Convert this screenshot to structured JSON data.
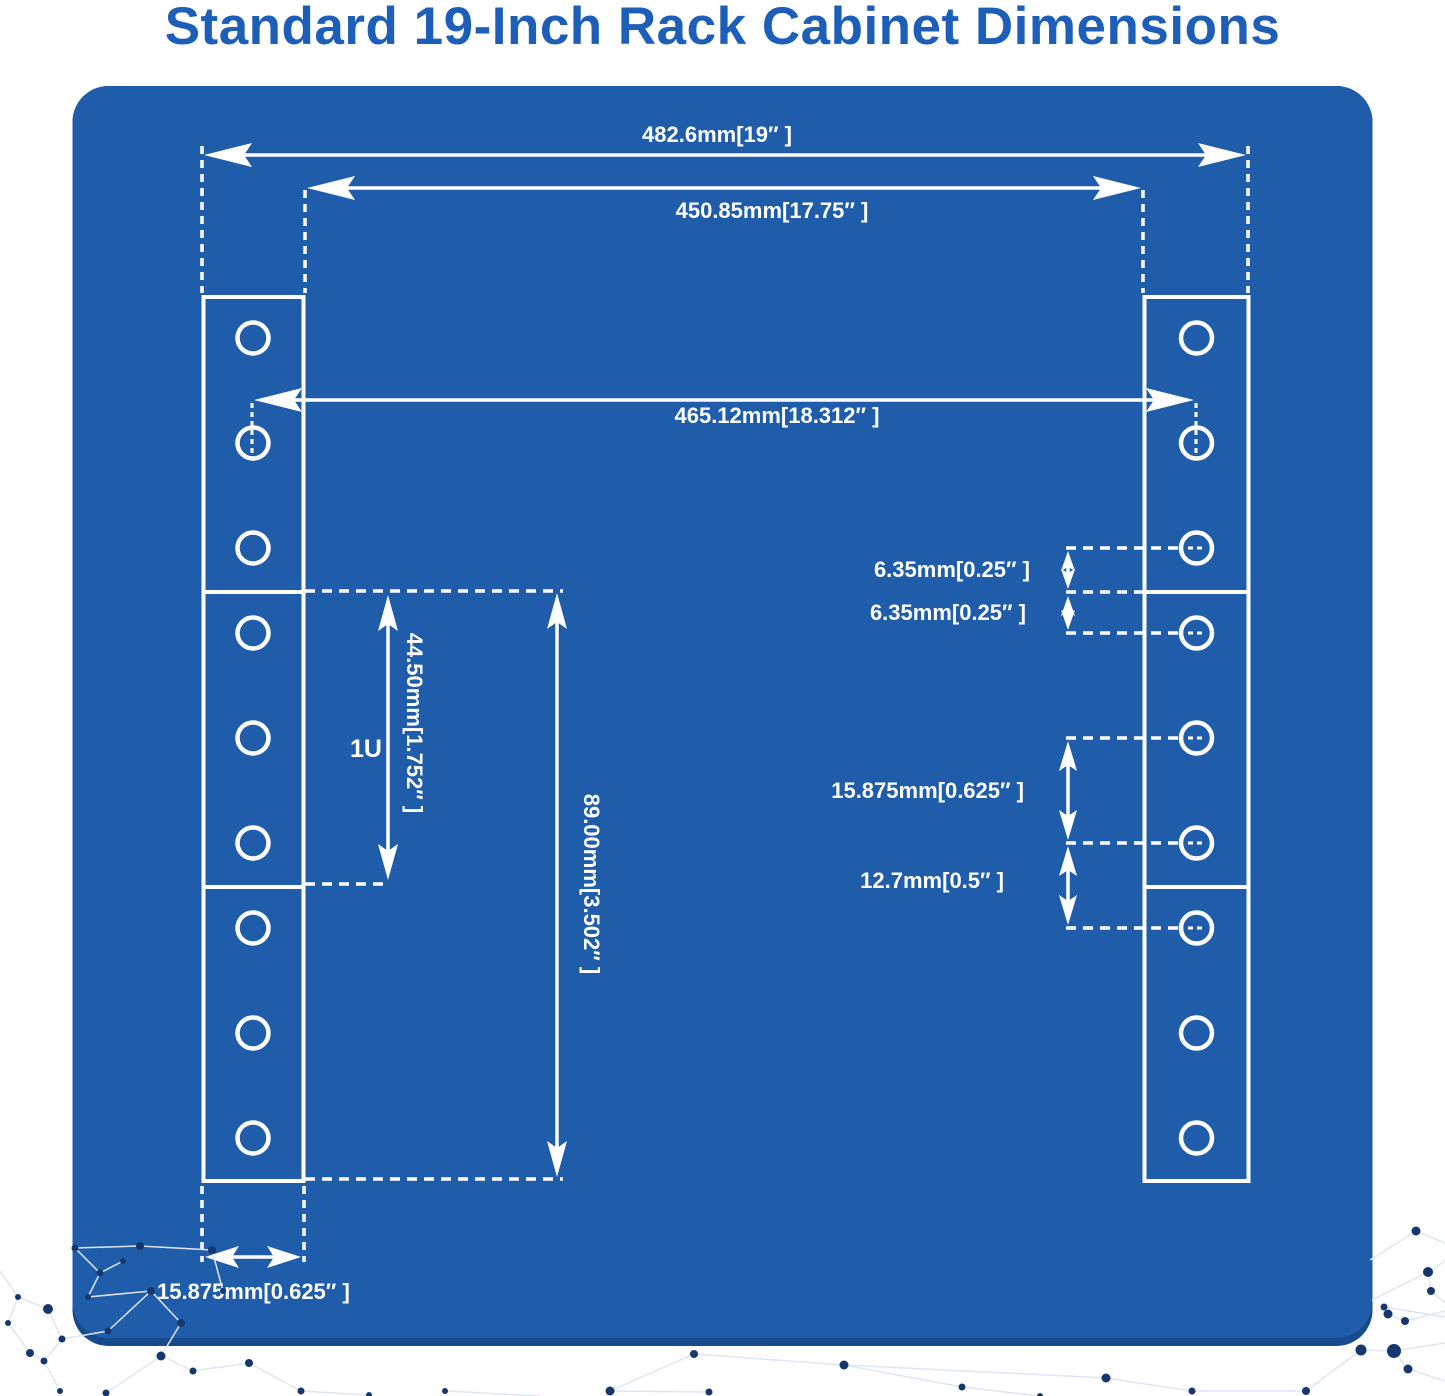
{
  "title": "Standard 19-Inch Rack Cabinet Dimensions",
  "labels": {
    "overall_width": "482.6mm[19″ ]",
    "inner_width": "450.85mm[17.75″ ]",
    "hole_span": "465.12mm[18.312″ ]",
    "unit": "1U",
    "unit_height": "44.50mm[1.752″ ]",
    "double_unit_height": "89.00mm[3.502″ ]",
    "hole_edge_top": "6.35mm[0.25″ ]",
    "hole_edge_bottom": "6.35mm[0.25″ ]",
    "hole_pitch": "15.875mm[0.625″ ]",
    "hole_pitch_boundary": "12.7mm[0.5″ ]",
    "flange_width": "15.875mm[0.625″ ]"
  },
  "colors": {
    "panel": "#1f5dab",
    "panel_edge": "#174a8c",
    "title": "#1d5eb8",
    "line": "#ffffff",
    "node": "#16376e",
    "web": "#dfe6f1"
  }
}
